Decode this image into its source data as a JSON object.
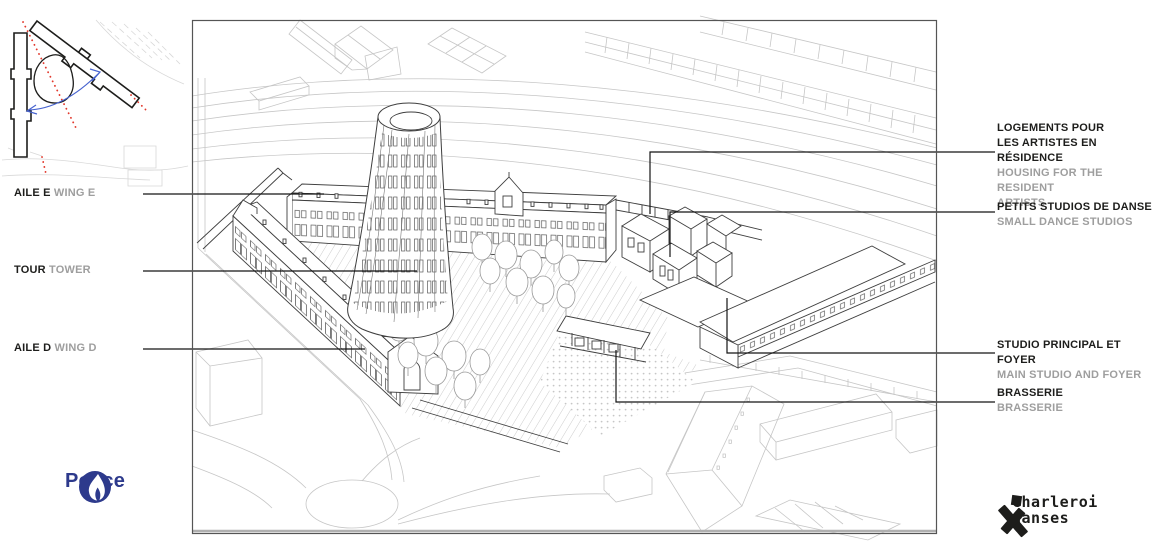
{
  "site_plan": {
    "axis_color": "#e23a2e",
    "rotation_arrow_color": "#4763cf",
    "building_outline_color": "#1d1d1b"
  },
  "labels_left": [
    {
      "fr": "AILE E",
      "en": "WING E"
    },
    {
      "fr": "TOUR",
      "en": "TOWER"
    },
    {
      "fr": "AILE D",
      "en": "WING D"
    }
  ],
  "labels_right": [
    {
      "fr1": "LOGEMENTS POUR",
      "fr2": "LES ARTISTES EN RÉSIDENCE",
      "en1": "HOUSING FOR THE RESIDENT",
      "en2": "ARTISTS"
    },
    {
      "fr1": "PETITS STUDIOS DE DANSE",
      "en1": "SMALL DANCE STUDIOS"
    },
    {
      "fr1": "STUDIO PRINCIPAL ET FOYER",
      "en1": "MAIN STUDIO AND FOYER"
    },
    {
      "fr1": "BRASSERIE",
      "en1": "BRASSERIE"
    }
  ],
  "logos": {
    "police": {
      "label": "Police",
      "color": "#2d3a8c"
    },
    "charleroi_danses": {
      "line1": "charleroi",
      "line2": "danses",
      "color": "#1d1d1b"
    }
  },
  "drawing": {
    "line_color": "#3f3f3f",
    "context_line_color": "#c3c3c3",
    "leader_line_color": "#141414",
    "label_text_color": "#1d1d1b",
    "label_translation_color": "#9e9e9e"
  }
}
